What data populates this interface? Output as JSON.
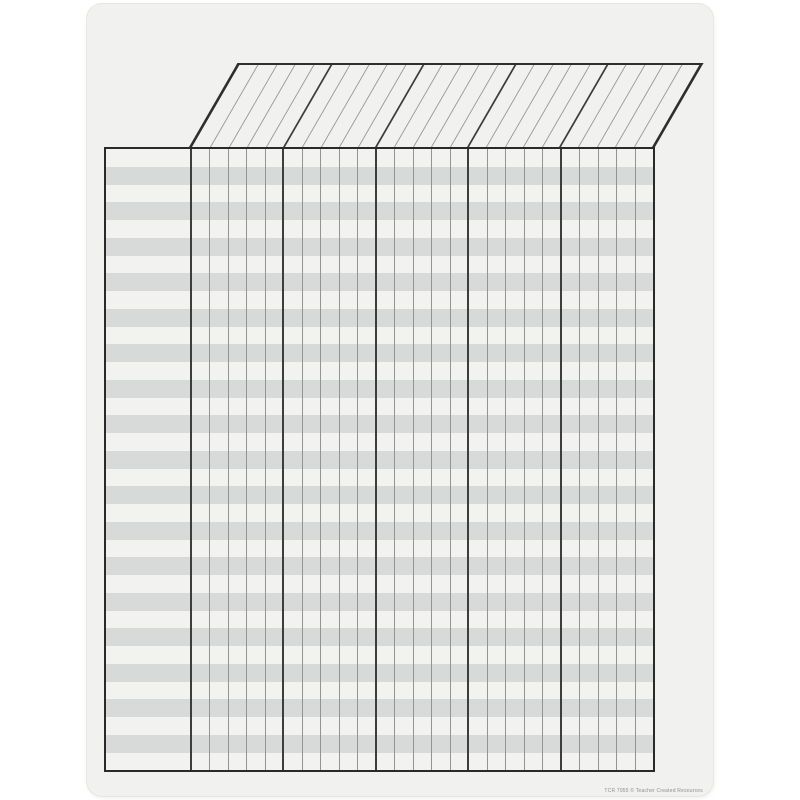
{
  "page": {
    "kind": "blank incentive chart poster",
    "background": "#f1f1ef",
    "canvas_background": "#ffffff"
  },
  "grid": {
    "rows": 35,
    "columns": 25,
    "column_group_size": 5,
    "has_name_column": true,
    "stripe_white": "#f2f2f0",
    "stripe_gray": "#d8dad9",
    "line_thin": "#949494",
    "line_thick": "#3d3d3d",
    "border": "#2a2a2a"
  },
  "header": {
    "style": "slanted-parallelogram",
    "skew_degrees": 30,
    "labels": []
  },
  "footer": {
    "credit": "TCR 7955 © Teacher Created Resources"
  }
}
